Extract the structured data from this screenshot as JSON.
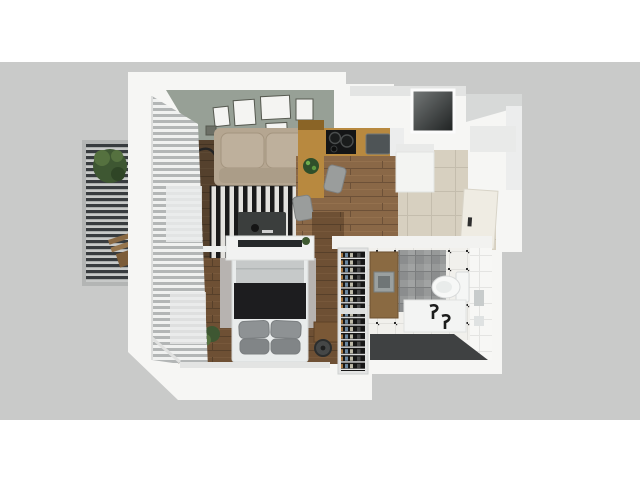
{
  "image": {
    "kind": "3d-apartment-floorplan-render",
    "width": 640,
    "height": 480,
    "view": "top-down cutaway studio apartment"
  },
  "palette": {
    "letterbox": "#ffffff",
    "backdrop": "#c9cac9",
    "wall": "#f6f6f4",
    "wall_cap": "#e3e4e3",
    "wall_cap_dark": "#d7d9d8",
    "accent_wall_green": "#97a096",
    "floor_living": "#55412d",
    "floor_living_line": "#3e2f20",
    "floor_kitchen": "#8a6847",
    "floor_kitchen_line": "#6d5138",
    "floor_bedroom": "#6e5034",
    "floor_bedroom_line": "#57402a",
    "tile_hall": "#d7d0c0",
    "tile_hall_line": "#c4bdad",
    "tile_bath": "#f1f0ec",
    "tile_bath_dot": "#2b2b2b",
    "tile_shower": "#979999",
    "tile_shower_dark": "#888a8b",
    "tile_wall_white": "#f7f7f5",
    "rug_stripe_dark": "#1b1b1b",
    "rug_stripe_light": "#e3e2de",
    "blind_light": "#f0f1f0",
    "blind_dark": "#b3b6b6",
    "railing_light": "#c7c9c8",
    "railing_dark": "#383c3f",
    "sofa": "#b5a691",
    "sofa_cushion": "#beb09c",
    "coffee_table": "#3b3e3d",
    "wood_golden": "#b8893f",
    "wood_golden_dark": "#8a6426",
    "cooktop": "#141516",
    "sink_metal": "#4e5456",
    "door": "#efece3",
    "bed_frame": "#e9ecec",
    "bed_sheet": "#c6c9c9",
    "bed_blanket": "#1d1d1f",
    "bed_pillow": "#8e9294",
    "bedroom_rug": "#b7b3b0",
    "shelf_books_bg": "#161616",
    "plant_green": "#3e5732",
    "plant_green_light": "#55713f",
    "shaft_dark": "#1d2020",
    "bath_dark_floor": "#3f4142",
    "tv_screen": "#26292a",
    "console_white": "#f1f2f1",
    "side_table": "#7a5836"
  },
  "rooms": [
    {
      "name": "living-room",
      "floor": "dark walnut planks",
      "feature": "sage green accent wall with framed art"
    },
    {
      "name": "kitchen-dining",
      "floor": "oak planks",
      "feature": "golden wood counters, cooktop, sink, dining table"
    },
    {
      "name": "hallway-entry",
      "floor": "beige ceramic tile",
      "feature": "entry door, shoe cabinet, ventilation shaft"
    },
    {
      "name": "bedroom",
      "floor": "oak planks with grey rug",
      "feature": "double bed facing tv console"
    },
    {
      "name": "bathroom",
      "floor": "white mosaic with black dots",
      "feature": "shower, wall-hung toilet, wood vanity"
    },
    {
      "name": "balcony",
      "floor": "outside left wall",
      "feature": "slatted railing, potted tree, wooden chair"
    }
  ],
  "furniture": {
    "living": [
      "sofa",
      "striped-area-rug",
      "coffee-table",
      "arc-floor-lamp",
      "picture-frames"
    ],
    "kitchen": [
      "tall-wood-cabinet",
      "dining-table",
      "dining-chairs",
      "fruit-bowl",
      "cooktop",
      "kitchen-sink",
      "counter"
    ],
    "hall": [
      "entry-door",
      "shoe-cabinet",
      "ventilation-shaft"
    ],
    "bedroom": [
      "bed",
      "pillows",
      "blanket",
      "tv-console",
      "tv",
      "wall-shelf",
      "bedside-table",
      "floor-speaker",
      "plant"
    ],
    "bathroom": [
      "wood-vanity",
      "vessel-sink",
      "shower-tiles",
      "toilet",
      "bath-counter",
      "black-faucets",
      "dark-floor-mat",
      "bookshelf"
    ],
    "balcony": [
      "railing",
      "potted-tree",
      "wood-chair"
    ]
  }
}
